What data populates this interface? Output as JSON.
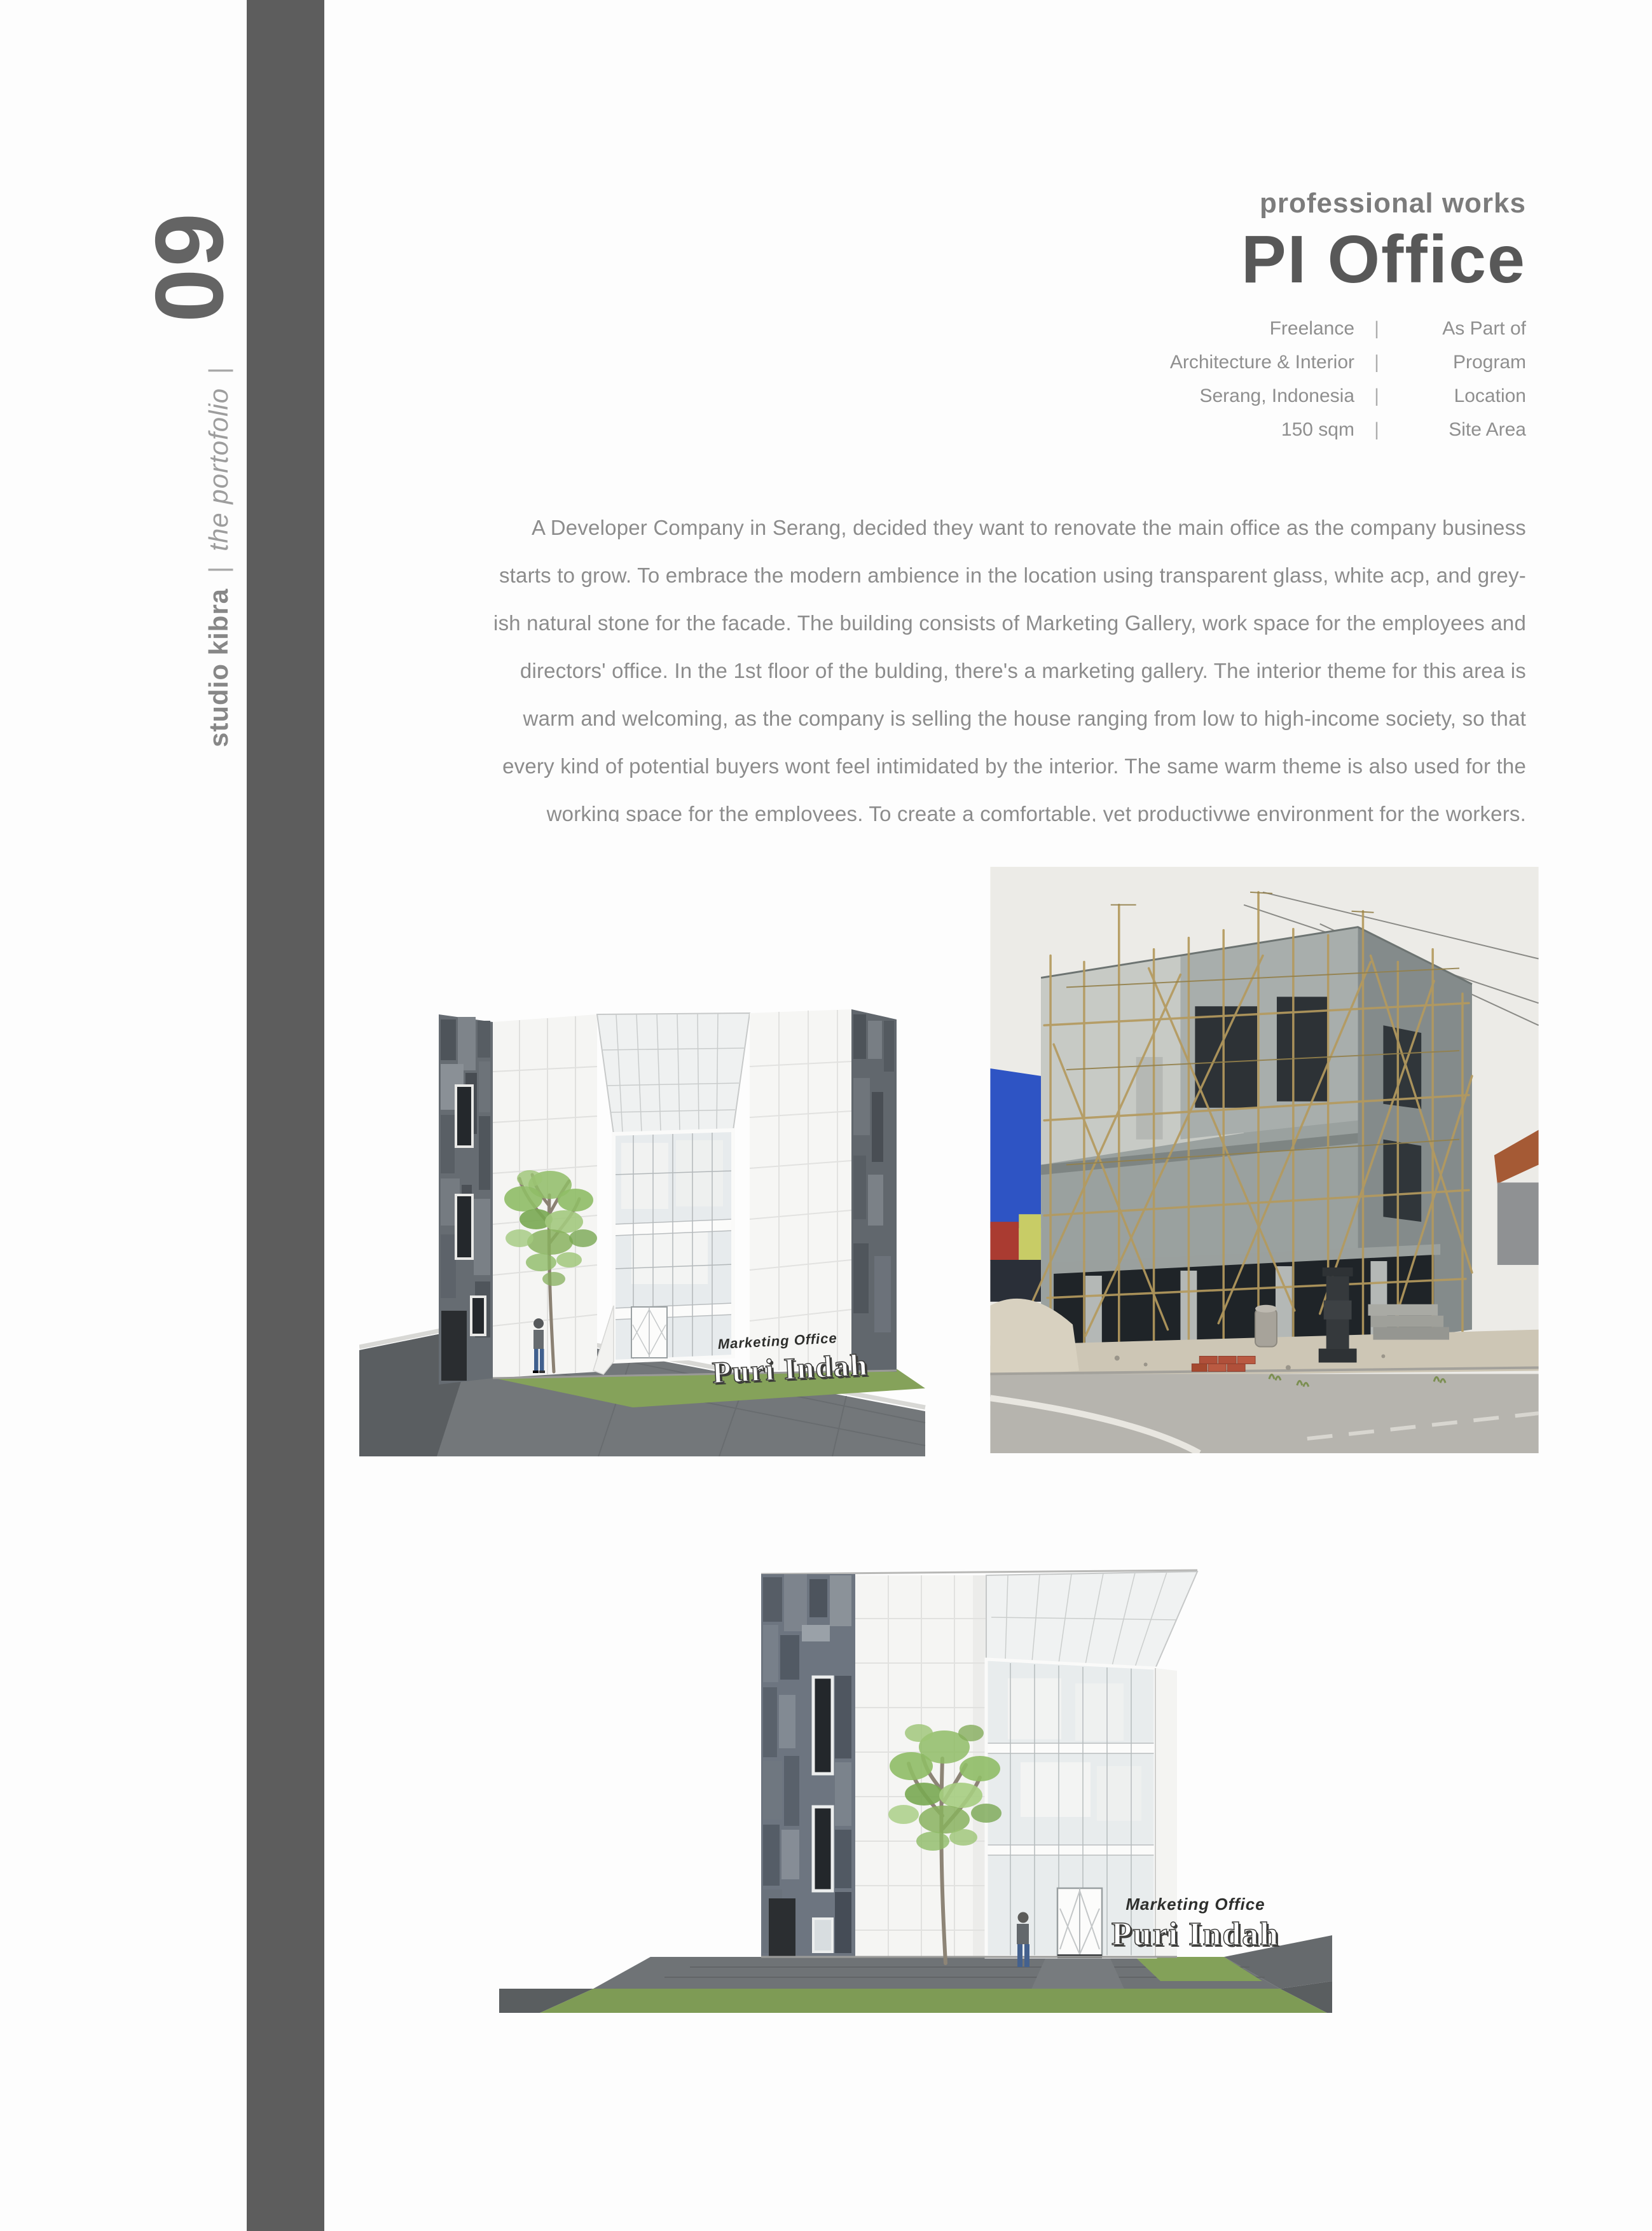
{
  "sidebar": {
    "page_number": "09",
    "studio": "studio kibra",
    "pipe": "|",
    "tagline": "the portofolio",
    "pipe_end": "|"
  },
  "header": {
    "eyebrow": "professional works",
    "title": "PI Office",
    "separator": "|",
    "meta": [
      {
        "value": "Freelance",
        "label": "As Part of"
      },
      {
        "value": "Architecture & Interior",
        "label": "Program"
      },
      {
        "value": "Serang, Indonesia",
        "label": "Location"
      },
      {
        "value": "150 sqm",
        "label": "Site Area"
      }
    ]
  },
  "body": {
    "lines": [
      "A  Developer Company in Serang, decided they want to renovate the main office as the company business",
      "starts to grow. To embrace the modern ambience in the location using transparent glass, white acp, and grey-",
      "ish natural stone for the facade. The building consists of Marketing Gallery, work space for the employees and",
      "directors' office. In the 1st floor of the bulding, there's a marketing gallery. The interior theme for this area is",
      "warm and welcoming, as the company is selling the house ranging from low to high-income society, so that",
      "every kind of potential buyers wont feel intimidated by the interior. The same warm theme is also used for the",
      "working space for the employees. To create a  comfortable, yet productivwe environment for the workers."
    ]
  },
  "images": {
    "render_perspective": {
      "sign_top": "Marketing Office",
      "sign_main": "Puri Indah"
    },
    "render_front": {
      "sign_top": "Marketing Office",
      "sign_main": "Puri Indah"
    }
  },
  "colors": {
    "rail": "#5d5d5d",
    "title": "#585858",
    "muted_text": "#8c8c8c",
    "lawn": "#85a25a",
    "stone": "#666c72",
    "scaffold": "#b49a5e",
    "photo_blue_building": "#2e54c4"
  }
}
